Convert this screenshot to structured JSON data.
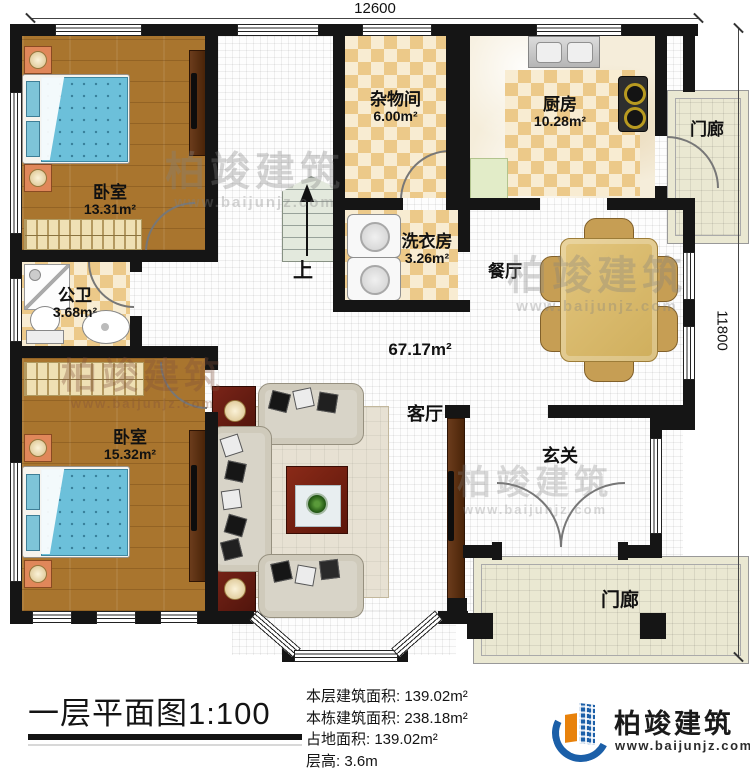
{
  "dimensions": {
    "width": "12600",
    "height": "11800"
  },
  "rooms": {
    "bedroom1": {
      "label": "卧室",
      "area": "13.31m²"
    },
    "storage": {
      "label": "杂物间",
      "area": "6.00m²"
    },
    "kitchen": {
      "label": "厨房",
      "area": "10.28m²"
    },
    "laundry": {
      "label": "洗衣房",
      "area": "3.26m²"
    },
    "bathroom": {
      "label": "公卫",
      "area": "3.68m²"
    },
    "bedroom2": {
      "label": "卧室",
      "area": "15.32m²"
    },
    "dining": {
      "label": "餐厅"
    },
    "living": {
      "label": "客厅"
    },
    "foyer": {
      "label": "玄关"
    },
    "porch_top": {
      "label": "门廊"
    },
    "porch_bottom": {
      "label": "门廊"
    }
  },
  "plan": {
    "hall_area": "67.17m²",
    "stairs_up": "上"
  },
  "title_block": {
    "title": "一层平面图",
    "scale": "1:100",
    "stats": [
      {
        "label": "本层建筑面积:",
        "value": "139.02m²"
      },
      {
        "label": "本栋建筑面积:",
        "value": "238.18m²"
      },
      {
        "label": "占地面积:",
        "value": "139.02m²"
      },
      {
        "label": "层高:",
        "value": "3.6m"
      }
    ]
  },
  "branding": {
    "company": "柏竣建筑",
    "website": "www.baijunjz.com"
  },
  "watermark": {
    "company": "柏竣建筑",
    "website": "www.baijunjz.com"
  },
  "colors": {
    "wall": "#151515",
    "wood_floor": "#a9752e",
    "tile_checker": "#ecc989",
    "bed_blue": "#6cc0da",
    "dining_table": "#d9ba6c",
    "logo_blue": "#1b5fa8",
    "logo_orange": "#e8820c"
  }
}
